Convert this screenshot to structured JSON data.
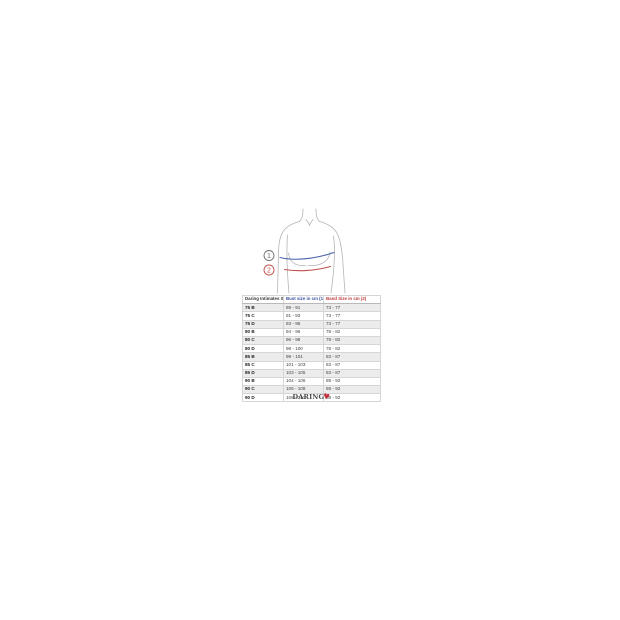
{
  "page": {
    "background": "#ffffff"
  },
  "diagram": {
    "description": "female torso outline with bust and under-bust measurement lines",
    "outline_color": "#b5b5b5",
    "bust_line_color": "#4a63aa",
    "band_line_color": "#c0504d",
    "markers": [
      {
        "label": "1",
        "color": "#6e6e6e"
      },
      {
        "label": "2",
        "color": "#c0504d"
      }
    ]
  },
  "chart_data": {
    "type": "table",
    "title": "Daring Intimates bra size chart",
    "columns": [
      "Daring Intimates Size",
      "Bust size in cm (1)",
      "Band Size in cm (2)"
    ],
    "column_colors": [
      "#333333",
      "#3a50a0",
      "#c03a3a"
    ],
    "rows": [
      [
        "75 B",
        "89 - 91",
        "73 - 77"
      ],
      [
        "75 C",
        "91 - 93",
        "73 - 77"
      ],
      [
        "75 D",
        "93 - 95",
        "73 - 77"
      ],
      [
        "80 B",
        "94 - 96",
        "78 - 82"
      ],
      [
        "80 C",
        "96 - 98",
        "78 - 82"
      ],
      [
        "80 D",
        "98 - 100",
        "78 - 82"
      ],
      [
        "85 B",
        "99 - 101",
        "83 - 87"
      ],
      [
        "85 C",
        "101 - 103",
        "83 - 87"
      ],
      [
        "85 D",
        "103 - 105",
        "83 - 87"
      ],
      [
        "90 B",
        "104 - 106",
        "88 - 92"
      ],
      [
        "90 C",
        "106 - 108",
        "88 - 92"
      ],
      [
        "90 D",
        "108 - 110",
        "88 - 92"
      ]
    ],
    "row_stripe_color": "#ececec",
    "grid": true,
    "legend_position": "none"
  },
  "logo": {
    "text": "DARING",
    "heart_glyph": "♥",
    "heart_color": "#c4303b"
  }
}
